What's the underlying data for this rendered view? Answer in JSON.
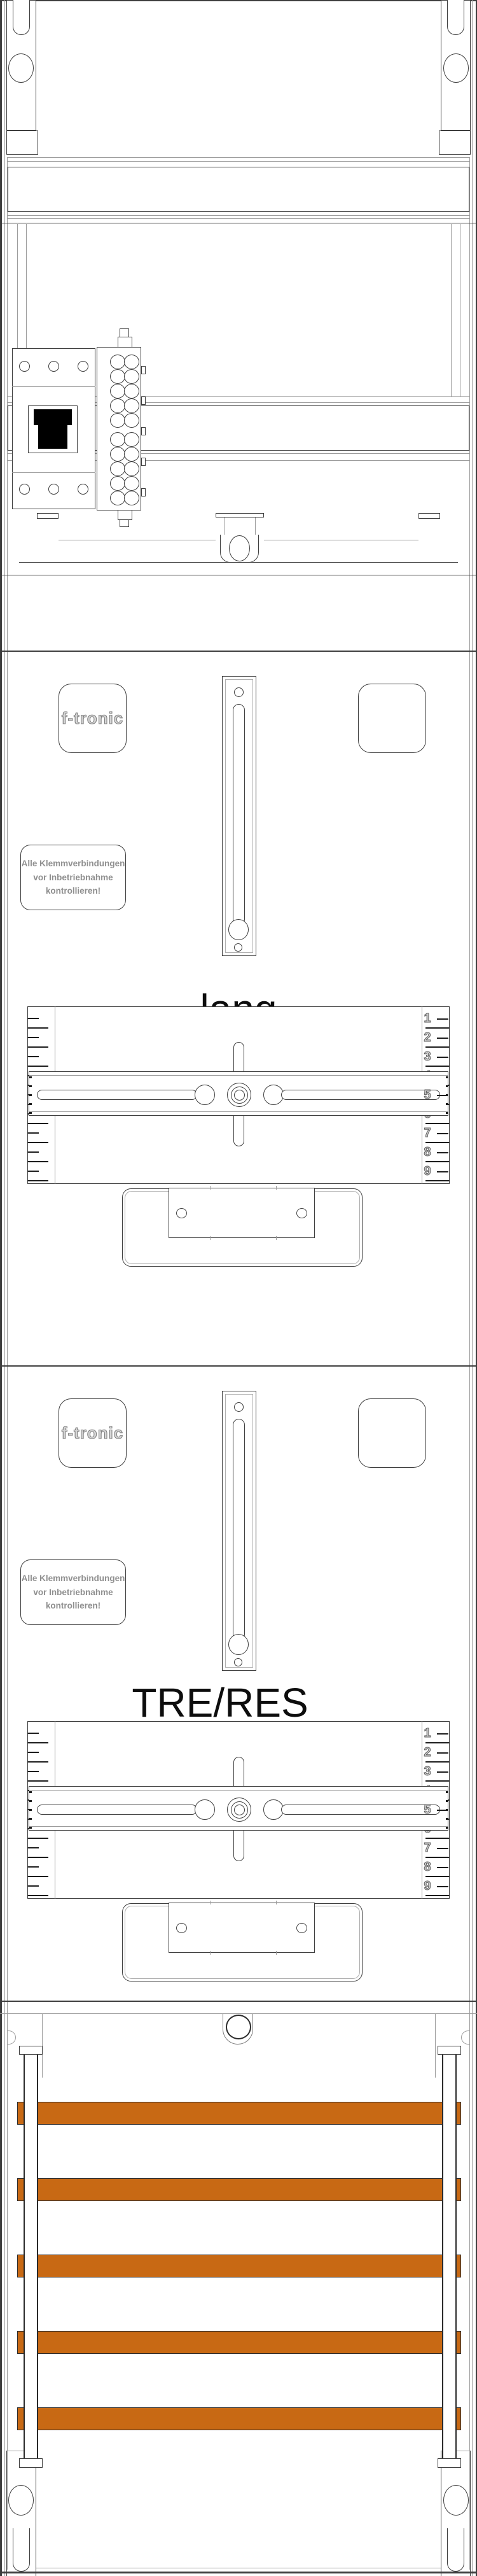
{
  "brand_label": "f-tronic",
  "warning_label": {
    "lines": [
      "Alle Klemmverbindungen",
      "vor Inbetriebnahme",
      "kontrollieren!"
    ]
  },
  "fields": [
    {
      "label": "lang"
    },
    {
      "label": "TRE/RES"
    }
  ],
  "ruler_numbers": [
    "1",
    "2",
    "3",
    "4",
    "5",
    "6",
    "7",
    "8",
    "9"
  ],
  "busbars": {
    "count": 5,
    "color": "#C86914"
  }
}
